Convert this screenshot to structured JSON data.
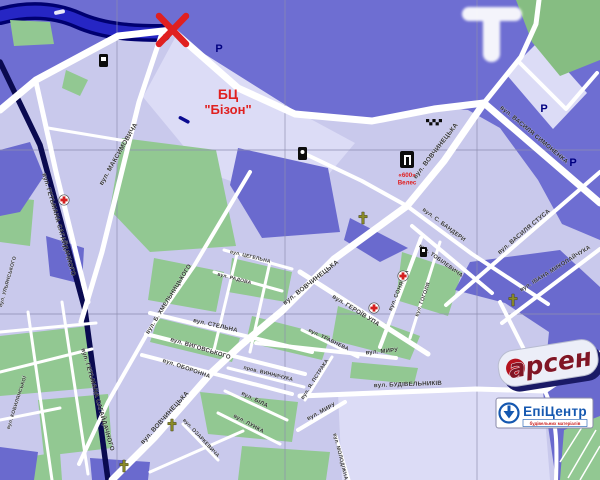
{
  "marks": {
    "x_marker": "X",
    "watermark_letter": "T"
  },
  "labels": {
    "bizon_line1": "БЦ",
    "bizon_line2": "\"Бізон\"",
    "veles_line1": "«600»",
    "veles_line2": "Велес"
  },
  "parking": [
    {
      "label": "P",
      "x": 219,
      "y": 52
    },
    {
      "label": "P",
      "x": 544,
      "y": 112
    },
    {
      "label": "P",
      "x": 573,
      "y": 166
    }
  ],
  "streets": [
    {
      "name": "вул. МАКСИМОВИЧА",
      "x": 120,
      "y": 155,
      "r": -60,
      "s": 6.5
    },
    {
      "name": "вул. ГЕТЬМАНА САГАЙДАЧНОГО",
      "x": 57,
      "y": 225,
      "r": 74,
      "s": 6.2
    },
    {
      "name": "вул. ГЕТЬМАНА САГАЙДАЧНОГО",
      "x": 96,
      "y": 400,
      "r": 74,
      "s": 6.2
    },
    {
      "name": "вул. ВОВЧИНЕЦЬКА",
      "x": 437,
      "y": 152,
      "r": -52,
      "s": 6.5
    },
    {
      "name": "вул. ВОВЧИНЕЦЬКА",
      "x": 312,
      "y": 284,
      "r": -38,
      "s": 6.5
    },
    {
      "name": "вул. ВОВЧИНЕЦЬКА",
      "x": 166,
      "y": 419,
      "r": -48,
      "s": 6.5
    },
    {
      "name": "вул. ВАСИЛЯ СИМОНЕНКА",
      "x": 533,
      "y": 136,
      "r": 40,
      "s": 6.2
    },
    {
      "name": "вул. ВАСИЛЯ СТУСА",
      "x": 525,
      "y": 233,
      "r": -40,
      "s": 6.2
    },
    {
      "name": "вул. ІВАНА МИКОЛАЙЧУКА",
      "x": 556,
      "y": 270,
      "r": -32,
      "s": 5.8
    },
    {
      "name": "вул. С. БАНДЕРИ",
      "x": 443,
      "y": 226,
      "r": 37,
      "s": 5.8
    },
    {
      "name": "вул. ТОБІЛЕВИЧА",
      "x": 440,
      "y": 262,
      "r": 36,
      "s": 5.6
    },
    {
      "name": "вул. СОНЯЧНА",
      "x": 400,
      "y": 291,
      "r": -67,
      "s": 5.6
    },
    {
      "name": "вул. ГОГОЛЯ",
      "x": 424,
      "y": 300,
      "r": -70,
      "s": 5.3
    },
    {
      "name": "вул. ГЕРОЇВ УПА",
      "x": 355,
      "y": 312,
      "r": 32,
      "s": 6.2
    },
    {
      "name": "вул. Б. ХМЕЛЬНИЦЬКОГО",
      "x": 170,
      "y": 300,
      "r": -58,
      "s": 6
    },
    {
      "name": "вул. СТЕЛЬНА",
      "x": 215,
      "y": 327,
      "r": 13,
      "s": 6
    },
    {
      "name": "вул. ВИГОВСЬКОГО",
      "x": 200,
      "y": 350,
      "r": 17,
      "s": 6
    },
    {
      "name": "вул. ОБОРОННА",
      "x": 186,
      "y": 370,
      "r": 19,
      "s": 5.8
    },
    {
      "name": "пров. ВИННИЧУКА",
      "x": 268,
      "y": 375,
      "r": 14,
      "s": 5.2
    },
    {
      "name": "вул. БІЛА",
      "x": 254,
      "y": 401,
      "r": 27,
      "s": 5.8
    },
    {
      "name": "вул. ЛУНКА",
      "x": 248,
      "y": 425,
      "r": 29,
      "s": 5.6
    },
    {
      "name": "вул. ОЗАРКЕВИЧА",
      "x": 200,
      "y": 439,
      "r": 47,
      "s": 5.2
    },
    {
      "name": "вул. МИРУ",
      "x": 382,
      "y": 353,
      "r": -5,
      "s": 6
    },
    {
      "name": "вул. МИРУ",
      "x": 322,
      "y": 413,
      "r": -28,
      "s": 5.8
    },
    {
      "name": "вул. БУДІВЕЛЬНИКІВ",
      "x": 408,
      "y": 386,
      "r": -2,
      "s": 6.2
    },
    {
      "name": "вул. Я. ПСТРАКА",
      "x": 316,
      "y": 380,
      "r": -57,
      "s": 5.3
    },
    {
      "name": "вул. МОЛОДІЖНА",
      "x": 339,
      "y": 457,
      "r": 76,
      "s": 5.2
    },
    {
      "name": "вул. ТРАВНЕВА",
      "x": 328,
      "y": 341,
      "r": 26,
      "s": 5.4
    },
    {
      "name": "вул. ЦЕГЕЛЬНА",
      "x": 250,
      "y": 258,
      "r": 14,
      "s": 5
    },
    {
      "name": "вул. РАДОВА",
      "x": 234,
      "y": 280,
      "r": 15,
      "s": 5
    },
    {
      "name": "вул. УЛЬЯНСЬКОГО",
      "x": 9,
      "y": 282,
      "r": -74,
      "s": 5
    },
    {
      "name": "вул. КОБИЛЯНСЬКОЇ",
      "x": 18,
      "y": 403,
      "r": -72,
      "s": 5
    }
  ],
  "logos": {
    "arsen": "арсен",
    "epicentr": "ЕпіЦентр",
    "epicentr_tagline": "будівельних матеріалів"
  },
  "colors": {
    "base": "#c9c9ec",
    "dark": "#6e6ed2",
    "dark2": "#6a6ace",
    "light": "#dcdcf6",
    "green": "#92c892",
    "park": "#86bd82",
    "river": "#2626c4",
    "river_edge": "#000070",
    "railway": "#0a0a50",
    "road": "#ffffff",
    "grid": "#8e8eb0",
    "red": "#e02020",
    "navy": "#000080",
    "label": "#1c1c1c",
    "arsen_maroon": "#801525",
    "epicentr_blue": "#1558b0"
  }
}
